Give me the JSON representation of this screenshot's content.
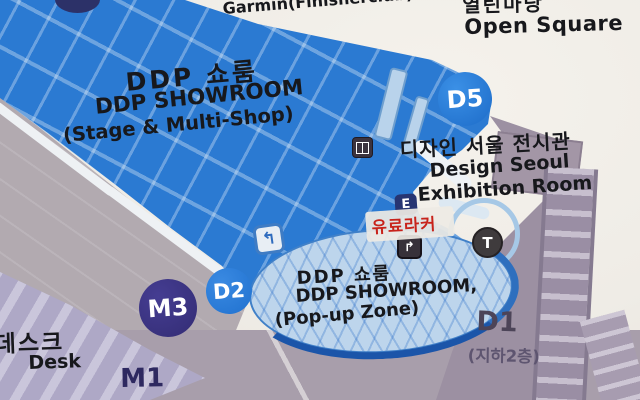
{
  "labels": {
    "garmin": "Garmin(Finisherclub)",
    "open_square_kr": "열린마당",
    "open_square_en": "Open Square",
    "showroom_stage": {
      "kr": "DDP 쇼룸",
      "en": "DDP SHOWROOM",
      "sub": "(Stage & Multi-Shop)"
    },
    "design_seoul": {
      "kr": "디자인 서울 전시관",
      "en_line1": "Design Seoul",
      "en_line2": "Exhibition Room"
    },
    "paid_locker": "유료라커",
    "showroom_popup": {
      "kr": "DDP 쇼룸",
      "en": "DDP SHOWROOM,",
      "sub": "(Pop-up Zone)"
    },
    "d1_area": {
      "code": "D1",
      "floor": "(지하2층)"
    },
    "desk": {
      "kr": "데스크",
      "en": "Desk"
    },
    "m1_code": "M1"
  },
  "badges": {
    "d5": "D5",
    "d2": "D2",
    "m3": "M3",
    "elevator_e": "E",
    "toilet_t": "T"
  },
  "icons": {
    "escalator_up_glyph": "↰",
    "escalator_down_glyph": "↱"
  },
  "colors": {
    "building_blue": "#2b7ad2",
    "oval_fill": "#bdd5ec",
    "oval_border_dark": "#1b55a9",
    "badge_blue": "#2071cf",
    "badge_navy": "#332c74",
    "e_badge_navy": "#273572",
    "t_badge_dark": "#3f3b3d",
    "locker_red": "#c8231b",
    "mauve": "#9c90a2",
    "gray": "#b2aab0",
    "lavender": "#aea8c6",
    "cream_bg": "#efece6",
    "d1_text": "#4c4458"
  }
}
